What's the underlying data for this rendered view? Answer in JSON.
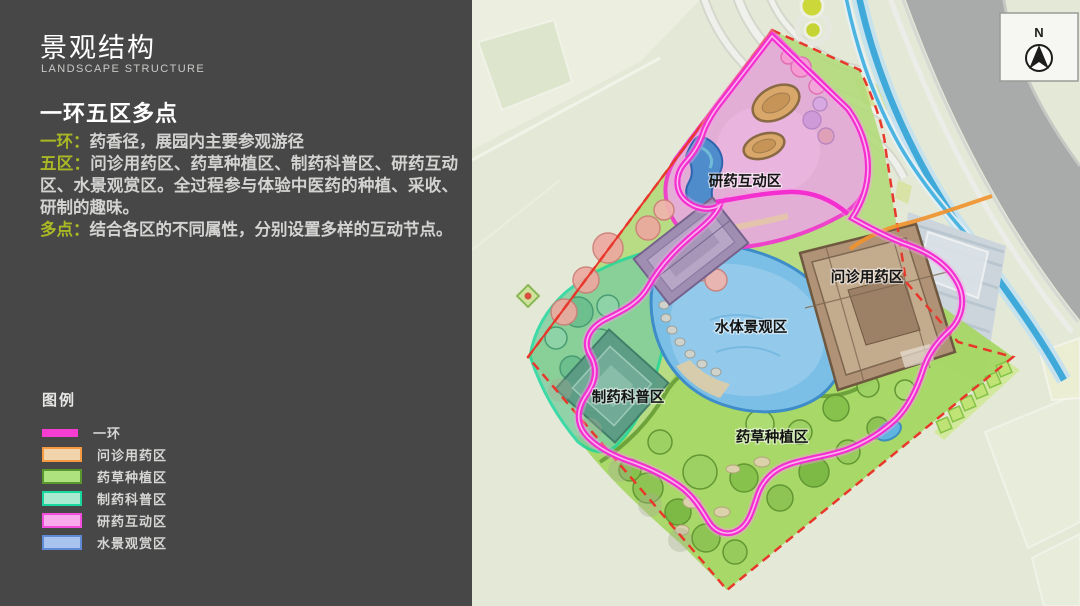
{
  "panel": {
    "title": "景观结构",
    "subtitle": "LANDSCAPE STRUCTURE",
    "heading": "一环五区多点",
    "accent_label_color": "#a9b824",
    "paragraphs": [
      {
        "label": "一环：",
        "text": "药香径，展园内主要参观游径"
      },
      {
        "label": "五区：",
        "text": "问诊用药区、药草种植区、制药科普区、研药互动区、水景观赏区。全过程参与体验中医药的种植、采收、研制的趣味。"
      },
      {
        "label": "多点：",
        "text": "结合各区的不同属性，分别设置多样的互动节点。"
      }
    ],
    "legend": {
      "title": "图例",
      "items": [
        {
          "label": "一环",
          "type": "line",
          "color": "#f53ed1"
        },
        {
          "label": "问诊用药区",
          "type": "box",
          "fill": "#f2d4ac",
          "border": "#f59a40"
        },
        {
          "label": "药草种植区",
          "type": "box",
          "fill": "#aee27f",
          "border": "#5a9630"
        },
        {
          "label": "制药科普区",
          "type": "box",
          "fill": "#a9ead0",
          "border": "#17d89e"
        },
        {
          "label": "研药互动区",
          "type": "box",
          "fill": "#f7abec",
          "border": "#f14cdd"
        },
        {
          "label": "水景观赏区",
          "type": "box",
          "fill": "#a9c3ef",
          "border": "#6089d6"
        }
      ]
    }
  },
  "map": {
    "north_label": "N",
    "labels": [
      {
        "text": "研药互动区"
      },
      {
        "text": "问诊用药区"
      },
      {
        "text": "水体景观区"
      },
      {
        "text": "制药科普区"
      },
      {
        "text": "药草种植区"
      }
    ],
    "colors": {
      "ring_route": "#f32fd0",
      "site_boundary": "#e8382c",
      "lake": "#7cbfe6",
      "river": "#3fa9d9",
      "road": "#a9abaa",
      "herb_zone": "#a6d765",
      "science_zone": "#7ecd9d",
      "research_zone": "#e7abdc",
      "clinic_building": "#b09377",
      "orange_path": "#f0922e"
    }
  }
}
